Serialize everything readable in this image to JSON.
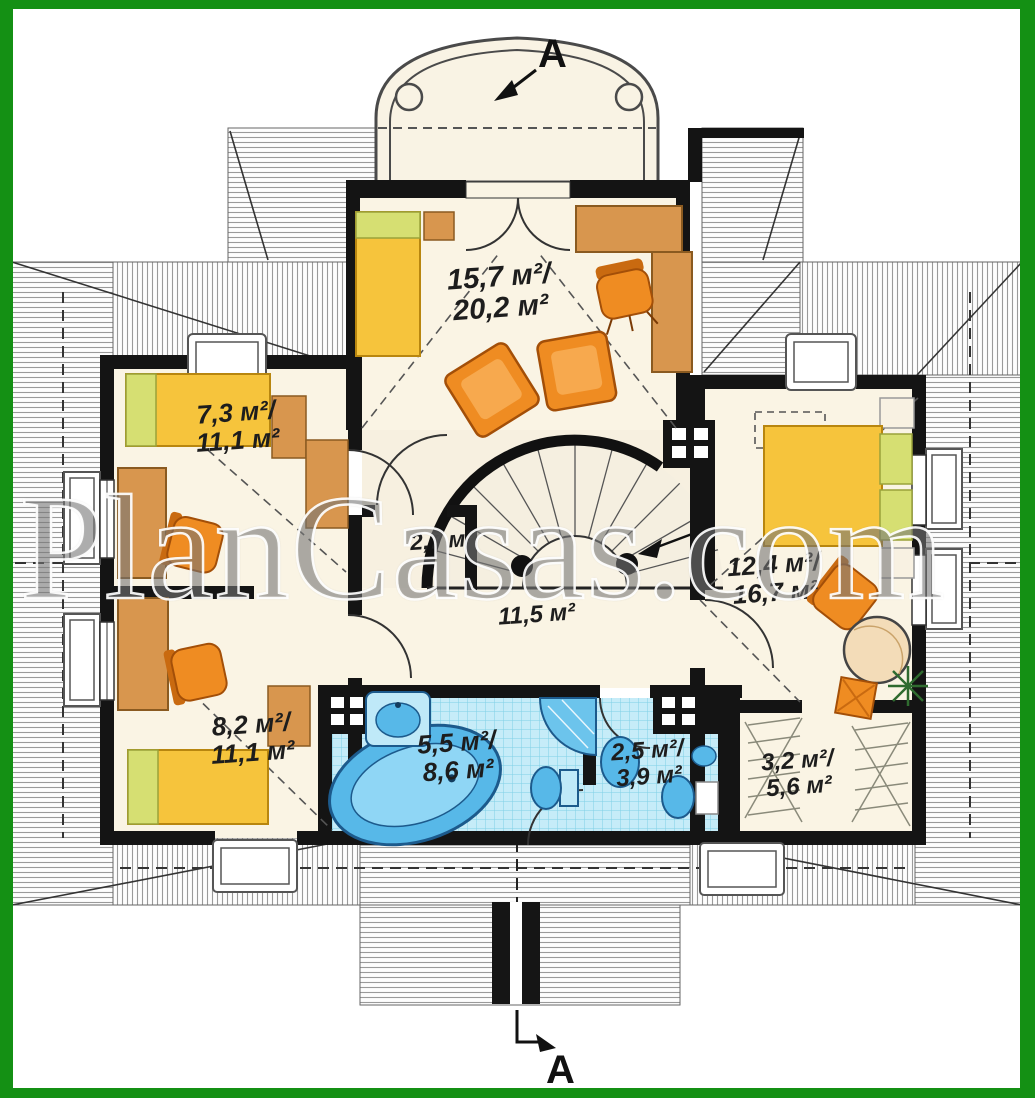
{
  "watermark": {
    "text": "PlanCasas.com"
  },
  "section": {
    "top_label": "A",
    "bottom_label": "A"
  },
  "labels": {
    "top_bedroom": {
      "line1": "15,7 м²/",
      "line2": "20,2 м²"
    },
    "left_bedroom": {
      "line1": "7,3 м²/",
      "line2": "11,1 м²"
    },
    "lower_left_bedroom": {
      "line1": "8,2 м²/",
      "line2": "11,1 м²"
    },
    "right_bedroom": {
      "line1": "12,4 м²/",
      "line2": "16,7 м²"
    },
    "closet": {
      "line1": "2,7 м²"
    },
    "hall": {
      "line1": "11,5 м²"
    },
    "bathroom": {
      "line1": "5,5 м²/",
      "line2": "8,6 м²"
    },
    "wc": {
      "line1": "2,5 м²/",
      "line2": "3,9 м²"
    },
    "wardrobe": {
      "line1": "3,2 м²/",
      "line2": "5,6 м²"
    }
  },
  "colors": {
    "frame_green": "#149014",
    "floor_cream": "#faf4e4",
    "wall_black": "#141414",
    "furniture_orange": "#ef8c22",
    "wood_brown": "#d8964e",
    "bed_yellow": "#f6c43c",
    "pillow_green": "#d6df72",
    "bath_tile_blue": "#c6ecf8",
    "fixture_blue": "#57b8e8"
  }
}
